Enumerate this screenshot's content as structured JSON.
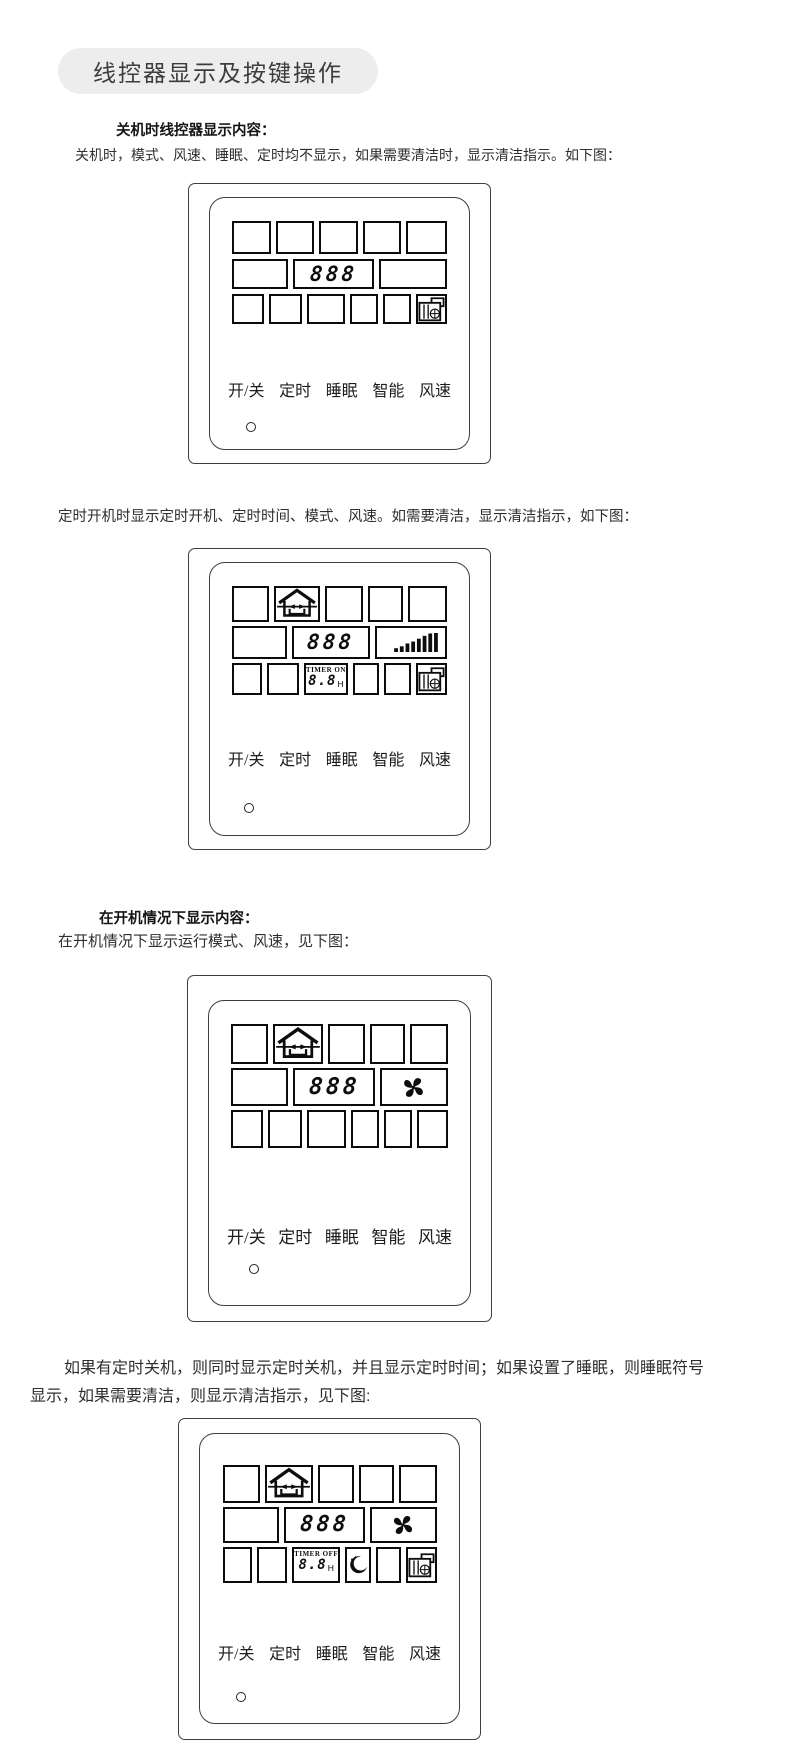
{
  "page": {
    "title": "线控器显示及按键操作",
    "background": "#ffffff",
    "title_pill_bg": "#ededed"
  },
  "sections": {
    "off_heading": "关机时线控器显示内容：",
    "off_body": "关机时，模式、风速、睡眠、定时均不显示，如果需要清洁时，显示清洁指示。如下图：",
    "timer_on_body": "定时开机时显示定时开机、定时时间、模式、风速。如需要清洁，显示清洁指示，如下图：",
    "on_heading": "在开机情况下显示内容：",
    "on_body": "在开机情况下显示运行模式、风速，见下图：",
    "timer_off_body_line1": "如果有定时关机，则同时显示定时关机，并且显示定时时间；如果设置了睡眠，则睡眠符号",
    "timer_off_body_line2": "显示，如果需要清洁，则显示清洁指示，见下图:"
  },
  "controller": {
    "buttons": [
      "开/关",
      "定时",
      "睡眠",
      "智能",
      "风速"
    ],
    "display_digits": "888",
    "timer_on_label": "TIMER ON",
    "timer_off_label": "TIMER OFF",
    "timer_hours": "8.8",
    "timer_unit": "H",
    "icons": {
      "mode": "home-mode-icon",
      "fan_speed": "fan-speed-bars-icon",
      "fan": "fan-blade-icon",
      "clean": "clean-filter-icon",
      "sleep": "sleep-moon-icon",
      "led": "led-indicator"
    },
    "line_color": "#1a1a1a"
  }
}
